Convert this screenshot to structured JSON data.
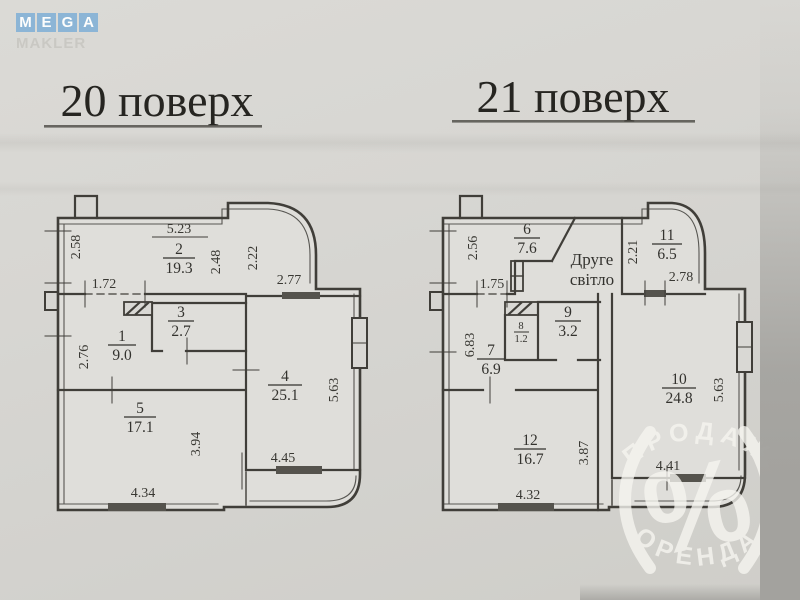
{
  "logo": {
    "letters": [
      "M",
      "E",
      "G",
      "A"
    ],
    "subtitle": "MAKLER",
    "tile_color": "#8cb5d6"
  },
  "watermark": {
    "arc_top": "ПРОДАЖ",
    "arc_bottom": "ОРЕНДА",
    "symbol": "%"
  },
  "plans": [
    {
      "title": "20 поверх",
      "rooms": [
        {
          "number": "2",
          "area": "19.3"
        },
        {
          "number": "1",
          "area": "9.0"
        },
        {
          "number": "3",
          "area": "2.7"
        },
        {
          "number": "4",
          "area": "25.1"
        },
        {
          "number": "5",
          "area": "17.1"
        }
      ],
      "dimensions": [
        "5.23",
        "2.58",
        "2.48",
        "2.22",
        "2.77",
        "1.72",
        "2.76",
        "5.63",
        "3.94",
        "4.45",
        "4.34"
      ]
    },
    {
      "title": "21 поверх",
      "note_line1": "Друге",
      "note_line2": "світло",
      "rooms": [
        {
          "number": "6",
          "area": "7.6"
        },
        {
          "number": "11",
          "area": "6.5"
        },
        {
          "number": "9",
          "area": "3.2"
        },
        {
          "number": "8",
          "area": "1.2"
        },
        {
          "number": "7",
          "area": "6.9"
        },
        {
          "number": "10",
          "area": "24.8"
        },
        {
          "number": "12",
          "area": "16.7"
        }
      ],
      "dimensions": [
        "2.56",
        "1.75",
        "2.21",
        "2.78",
        "6.83",
        "5.63",
        "3.87",
        "4.41",
        "4.32"
      ]
    }
  ]
}
